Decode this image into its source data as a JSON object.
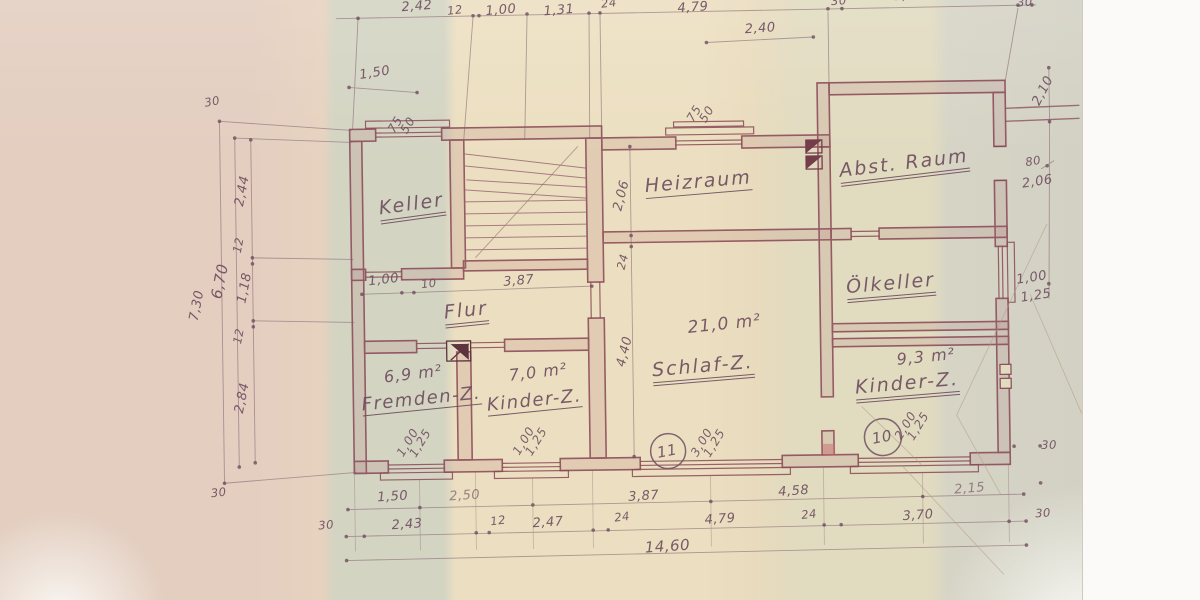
{
  "drawing": {
    "kind": "hand-drawn basement floor plan (scanned blueprint photo)",
    "language": "de",
    "line_color": "#8a4a57",
    "paper_color": "#ecdfc1",
    "ink_color": "#6f4f60"
  },
  "rooms": {
    "keller": {
      "label": "Keller"
    },
    "flur": {
      "label": "Flur"
    },
    "heizraum": {
      "label": "Heizraum"
    },
    "abst_raum": {
      "label": "Abst. Raum"
    },
    "oelkeller": {
      "label": "Ölkeller"
    },
    "schlaf_z": {
      "label": "Schlaf-Z.",
      "area": "21,0 m²",
      "position_no": "11"
    },
    "fremden_z": {
      "label": "Fremden-Z.",
      "area": "6,9 m²"
    },
    "kinder_z_left": {
      "label": "Kinder-Z.",
      "area": "7,0 m²"
    },
    "kinder_z_right": {
      "label": "Kinder-Z.",
      "area": "9,3 m²",
      "position_no": "10"
    }
  },
  "windows": {
    "keller_top": {
      "w": "75",
      "h": "50"
    },
    "heizraum_top": {
      "w": "75",
      "h": "50"
    },
    "fremden_z": {
      "w": "1,00",
      "h": "1,25"
    },
    "kinder_z_left": {
      "w": "1,00",
      "h": "1,25"
    },
    "schlaf_z": {
      "w": "3,00",
      "h": "1,25"
    },
    "kinder_z_right": {
      "w": "2,00",
      "h": "1,25"
    },
    "oelkeller_right": {
      "w": "1,00",
      "h": "1,25"
    },
    "abst_raum_door": {
      "w": "80",
      "h": "2,06"
    }
  },
  "dims": {
    "top_row": [
      "2,42",
      "12",
      "1,00",
      "1,31",
      "24",
      "4,79",
      "30",
      "3,70",
      "30"
    ],
    "keller_window_width": "1,50",
    "heizraum_window_width": "2,40",
    "right_top_height": "2,10",
    "left": {
      "wall_top": "30",
      "total": "7,30",
      "inner": "6,70",
      "segments": [
        "2,44",
        "12",
        "1,18",
        "12",
        "2,84"
      ],
      "wall_bottom": "30"
    },
    "bottom": {
      "row1": [
        "1,50",
        "2,50",
        "3,87",
        "4,58",
        "2,15"
      ],
      "row2": [
        "30",
        "2,43",
        "12",
        "2,47",
        "24",
        "4,79",
        "24",
        "3,70",
        "30"
      ],
      "total": "14,60",
      "right_wall": "30"
    },
    "keller_door": "1,00",
    "keller_door_jamb": "10",
    "flur_length": "3,87",
    "heizraum_depth": "2,06",
    "center_wall": "24",
    "schlaf_depth": "4,40"
  }
}
